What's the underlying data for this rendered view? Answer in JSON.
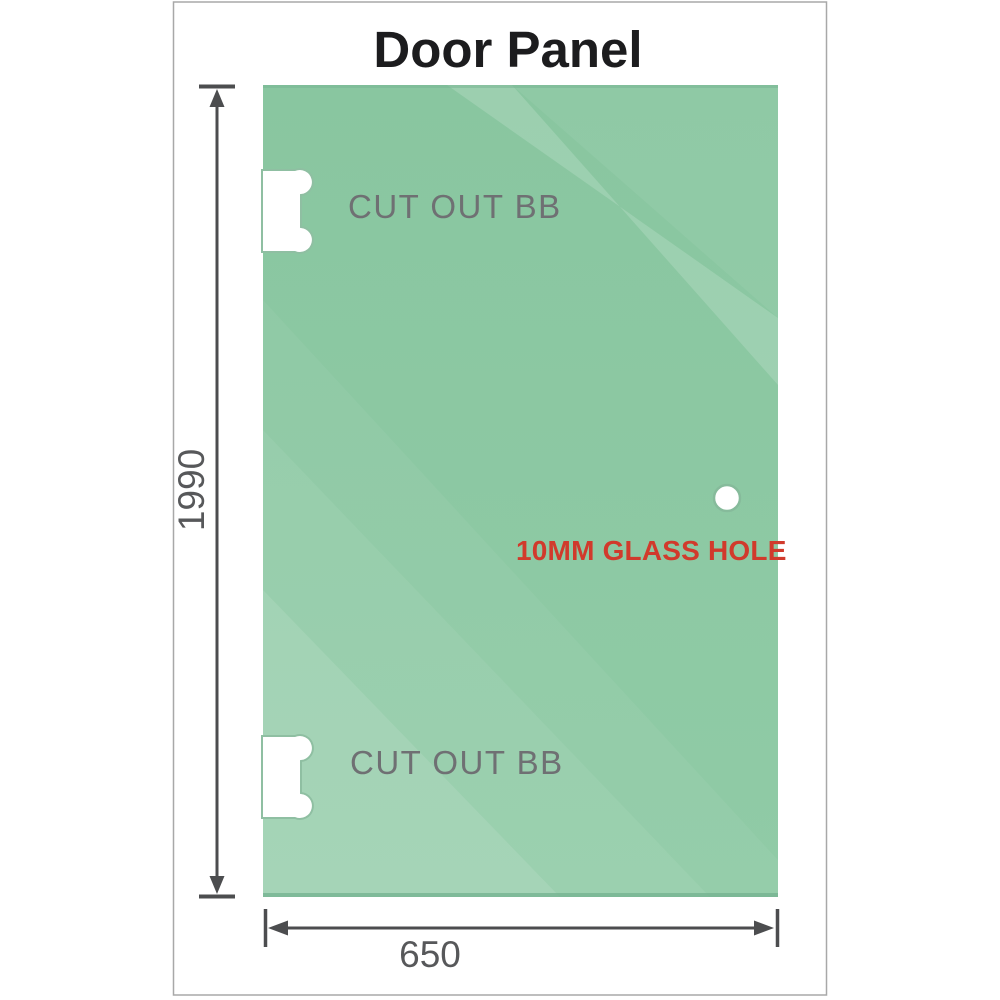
{
  "title": "Door Panel",
  "panel": {
    "cutouts": [
      {
        "label": "CUT OUT BB"
      },
      {
        "label": "CUT OUT BB"
      }
    ],
    "hole": {
      "label": "10MM GLASS HOLE"
    }
  },
  "dimensions": {
    "height": {
      "value": "1990"
    },
    "width": {
      "value": "650"
    }
  },
  "colors": {
    "glass_top": "#89c6a0",
    "glass_bottom": "#90cba6",
    "glass_highlight": "#ffffff",
    "glass_edge": "#76b391",
    "cutout_outline": "#8fbfa2",
    "hole_outline": "#86bb9b",
    "dimension_line": "#4c4d4f",
    "dimension_text": "#57585a",
    "cutout_text": "#6f7073",
    "hole_text": "#d13a2c",
    "title_text": "#1c1c1e",
    "frame_border": "#a8a8a8"
  }
}
